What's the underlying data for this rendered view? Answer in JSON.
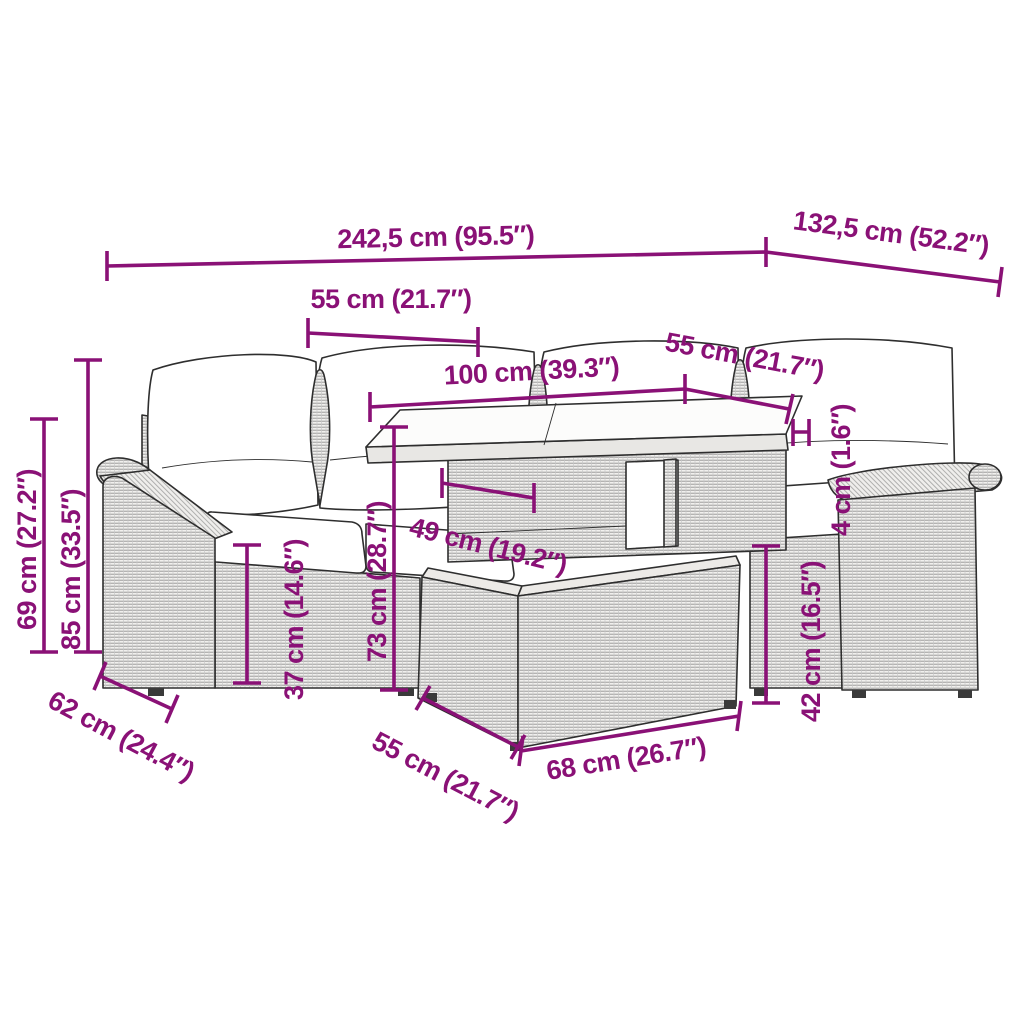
{
  "page": {
    "background": "#ffffff"
  },
  "diagram": {
    "accent_color": "#8A1176",
    "outline_color": "#2e2e2e",
    "subject": "rattan-garden-lounge-set-with-table-and-ottoman",
    "labels": {
      "total_width": "242,5 cm (95.5″)",
      "side_depth": "132,5 cm (52.2″)",
      "seat_width_left": "55 cm (21.7″)",
      "table_top_width": "100 cm (39.3″)",
      "seat_width_right": "55 cm (21.7″)",
      "tabletop_thickness": "4 cm (1.6″)",
      "backrest_height": "85 cm (33.5″)",
      "armrest_height": "69 cm (27.2″)",
      "seat_height": "37 cm (14.6″)",
      "table_height": "73 cm (28.7″)",
      "table_shelf_width": "49 cm (19.2″)",
      "seat_depth": "62 cm (24.4″)",
      "ottoman_depth": "55 cm (21.7″)",
      "ottoman_width": "68 cm (26.7″)",
      "ottoman_height": "42 cm (16.5″)"
    }
  }
}
